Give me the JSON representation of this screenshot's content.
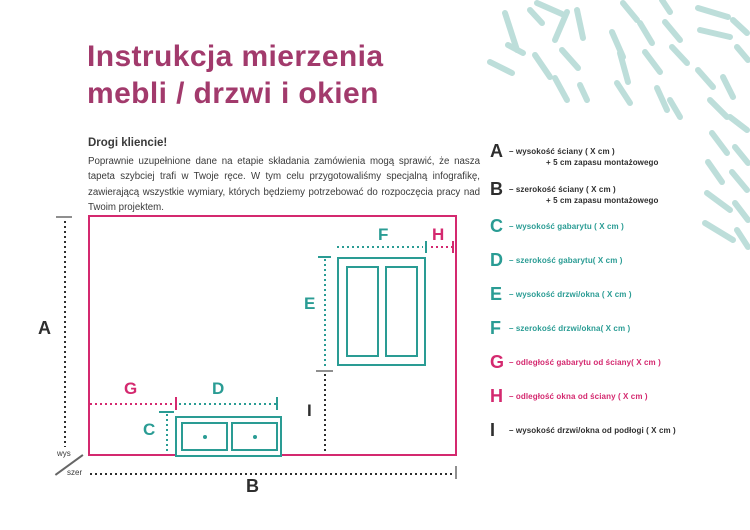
{
  "title": "Instrukcja mierzenia\nmebli / drzwi i okien",
  "intro": {
    "greeting": "Drogi kliencie!",
    "paragraph": "Poprawnie uzupełnione dane na etapie składania zamówienia mogą sprawić, że nasza tapeta szybciej trafi w Twoje ręce. W tym celu przygotowaliśmy specjalną infografikę, zawierającą wszystkie wymiary, których będziemy potrzebować do rozpoczęcia pracy nad Twoim projektem."
  },
  "diagram": {
    "labels": {
      "A": "A",
      "B": "B",
      "C": "C",
      "D": "D",
      "E": "E",
      "F": "F",
      "G": "G",
      "H": "H",
      "I": "I"
    },
    "axis_height_label": "wys",
    "axis_width_label": "szer"
  },
  "legend": {
    "items": [
      {
        "letter": "A",
        "color": "black",
        "line1": "– wysokość ściany  ( X cm )",
        "line2": "+ 5 cm zapasu montażowego"
      },
      {
        "letter": "B",
        "color": "black",
        "line1": "– szerokość ściany  ( X cm )",
        "line2": "+ 5 cm zapasu montażowego"
      },
      {
        "letter": "C",
        "color": "teal",
        "line1": "– wysokość gabarytu ( X cm )"
      },
      {
        "letter": "D",
        "color": "teal",
        "line1": "– szerokość gabarytu( X cm )"
      },
      {
        "letter": "E",
        "color": "teal",
        "line1": "– wysokość drzwi/okna ( X cm )"
      },
      {
        "letter": "F",
        "color": "teal",
        "line1": "– szerokość drzwi/okna( X cm )"
      },
      {
        "letter": "G",
        "color": "pink",
        "line1": "– odległość gabarytu od ściany( X cm )"
      },
      {
        "letter": "H",
        "color": "pink",
        "line1": "– odległość okna od ściany ( X cm )"
      },
      {
        "letter": "I",
        "color": "black",
        "line1": "– wysokość drzwi/okna od podłogi ( X cm )"
      }
    ]
  },
  "colors": {
    "title": "#a23a6c",
    "pink": "#d4296f",
    "teal": "#2a9c94",
    "black": "#2e2e2e",
    "leaf": "#bddeda",
    "gray": "#8f8f8f"
  }
}
